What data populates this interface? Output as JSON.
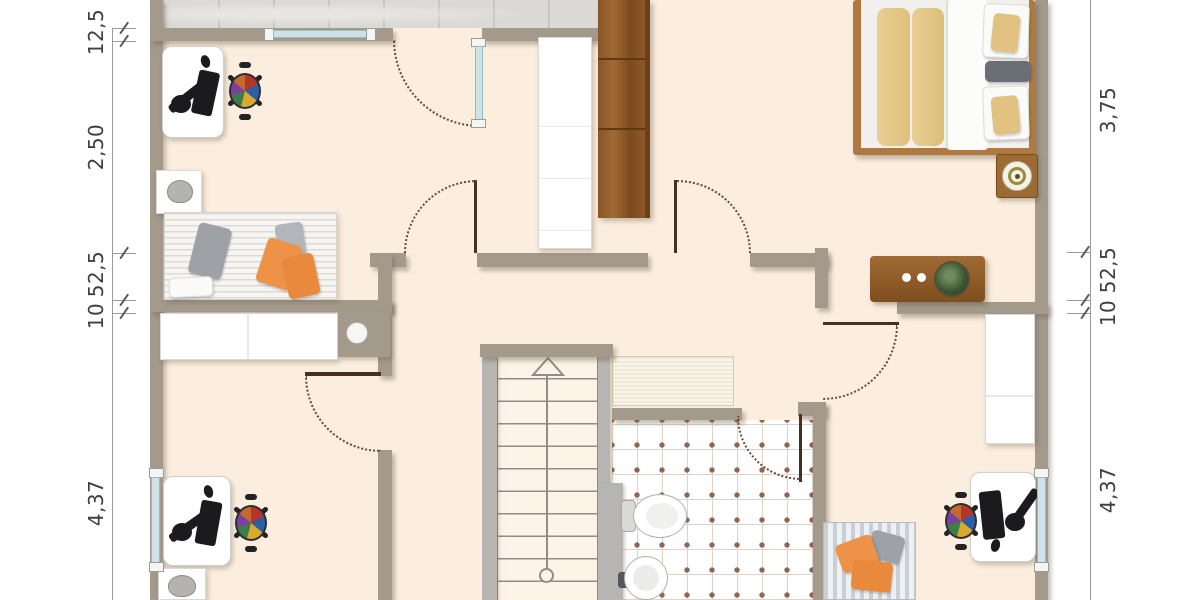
{
  "dimensions": {
    "left": [
      "12,5",
      "2,50",
      "52,5",
      "10",
      "4,37"
    ],
    "right": [
      "3,75",
      "52,5",
      "10",
      "4,37"
    ]
  },
  "palette": {
    "wall": "#a39a8c",
    "floor": "#fceede",
    "terrace_concrete": "#dbdad6",
    "window_glass": "#cde3e9",
    "wood_wardrobe": "#8a5527",
    "wood_sideboard": "#9a6530",
    "bathroom_tile_dot": "#8f6450",
    "stair_gray": "#b6b5b1",
    "pillow_orange": "#ee9248",
    "door_swing_arc": "#6e4636"
  },
  "symbols": {
    "stairs_arrow": "up-direction-triangle",
    "plant": "potted-plant-top-view",
    "lamp": "bedside-lamp-top-view",
    "basin": "round-basin"
  }
}
